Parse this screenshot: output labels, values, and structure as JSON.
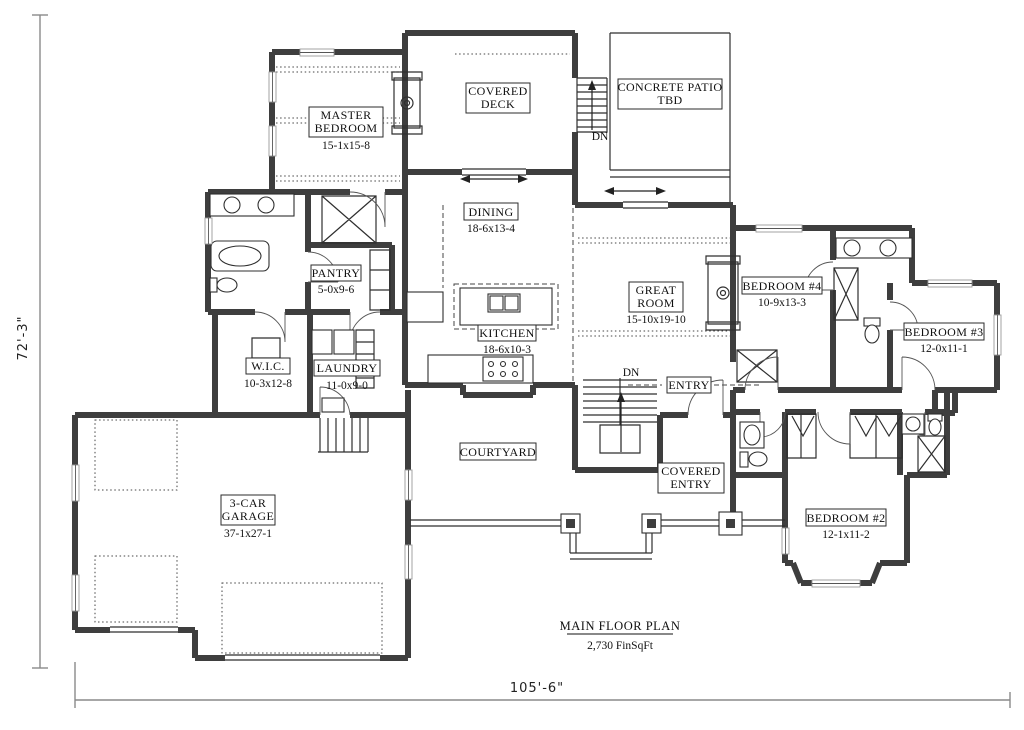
{
  "title": {
    "name": "MAIN FLOOR PLAN",
    "area": "2,730 FinSqFt"
  },
  "dimensions": {
    "height": "72'-3\"",
    "width": "105'-6\""
  },
  "annotations": {
    "down": "DN"
  },
  "rooms": {
    "master_bedroom": {
      "line1": "MASTER",
      "line2": "BEDROOM",
      "dims": "15-1x15-8"
    },
    "covered_deck": {
      "line1": "COVERED",
      "line2": "DECK"
    },
    "concrete_patio": {
      "line1": "CONCRETE PATIO",
      "line2": "TBD"
    },
    "dining": {
      "name": "DINING",
      "dims": "18-6x13-4"
    },
    "pantry": {
      "name": "PANTRY",
      "dims": "5-0x9-6"
    },
    "great_room": {
      "line1": "GREAT",
      "line2": "ROOM",
      "dims": "15-10x19-10"
    },
    "kitchen": {
      "name": "KITCHEN",
      "dims": "18-6x10-3"
    },
    "bedroom4": {
      "name": "BEDROOM #4",
      "dims": "10-9x13-3"
    },
    "bedroom3": {
      "name": "BEDROOM #3",
      "dims": "12-0x11-1"
    },
    "wic": {
      "name": "W.I.C.",
      "dims": "10-3x12-8"
    },
    "laundry": {
      "name": "LAUNDRY",
      "dims": "11-0x9-0"
    },
    "entry": {
      "name": "ENTRY"
    },
    "courtyard": {
      "name": "COURTYARD"
    },
    "covered_entry": {
      "line1": "COVERED",
      "line2": "ENTRY"
    },
    "bedroom2": {
      "name": "BEDROOM #2",
      "dims": "12-1x11-2"
    },
    "garage": {
      "line1": "3-CAR",
      "line2": "GARAGE",
      "dims": "37-1x27-1"
    }
  },
  "colors": {
    "wall": "#3e3e3e",
    "line": "#2f2f2f",
    "background": "#ffffff"
  }
}
